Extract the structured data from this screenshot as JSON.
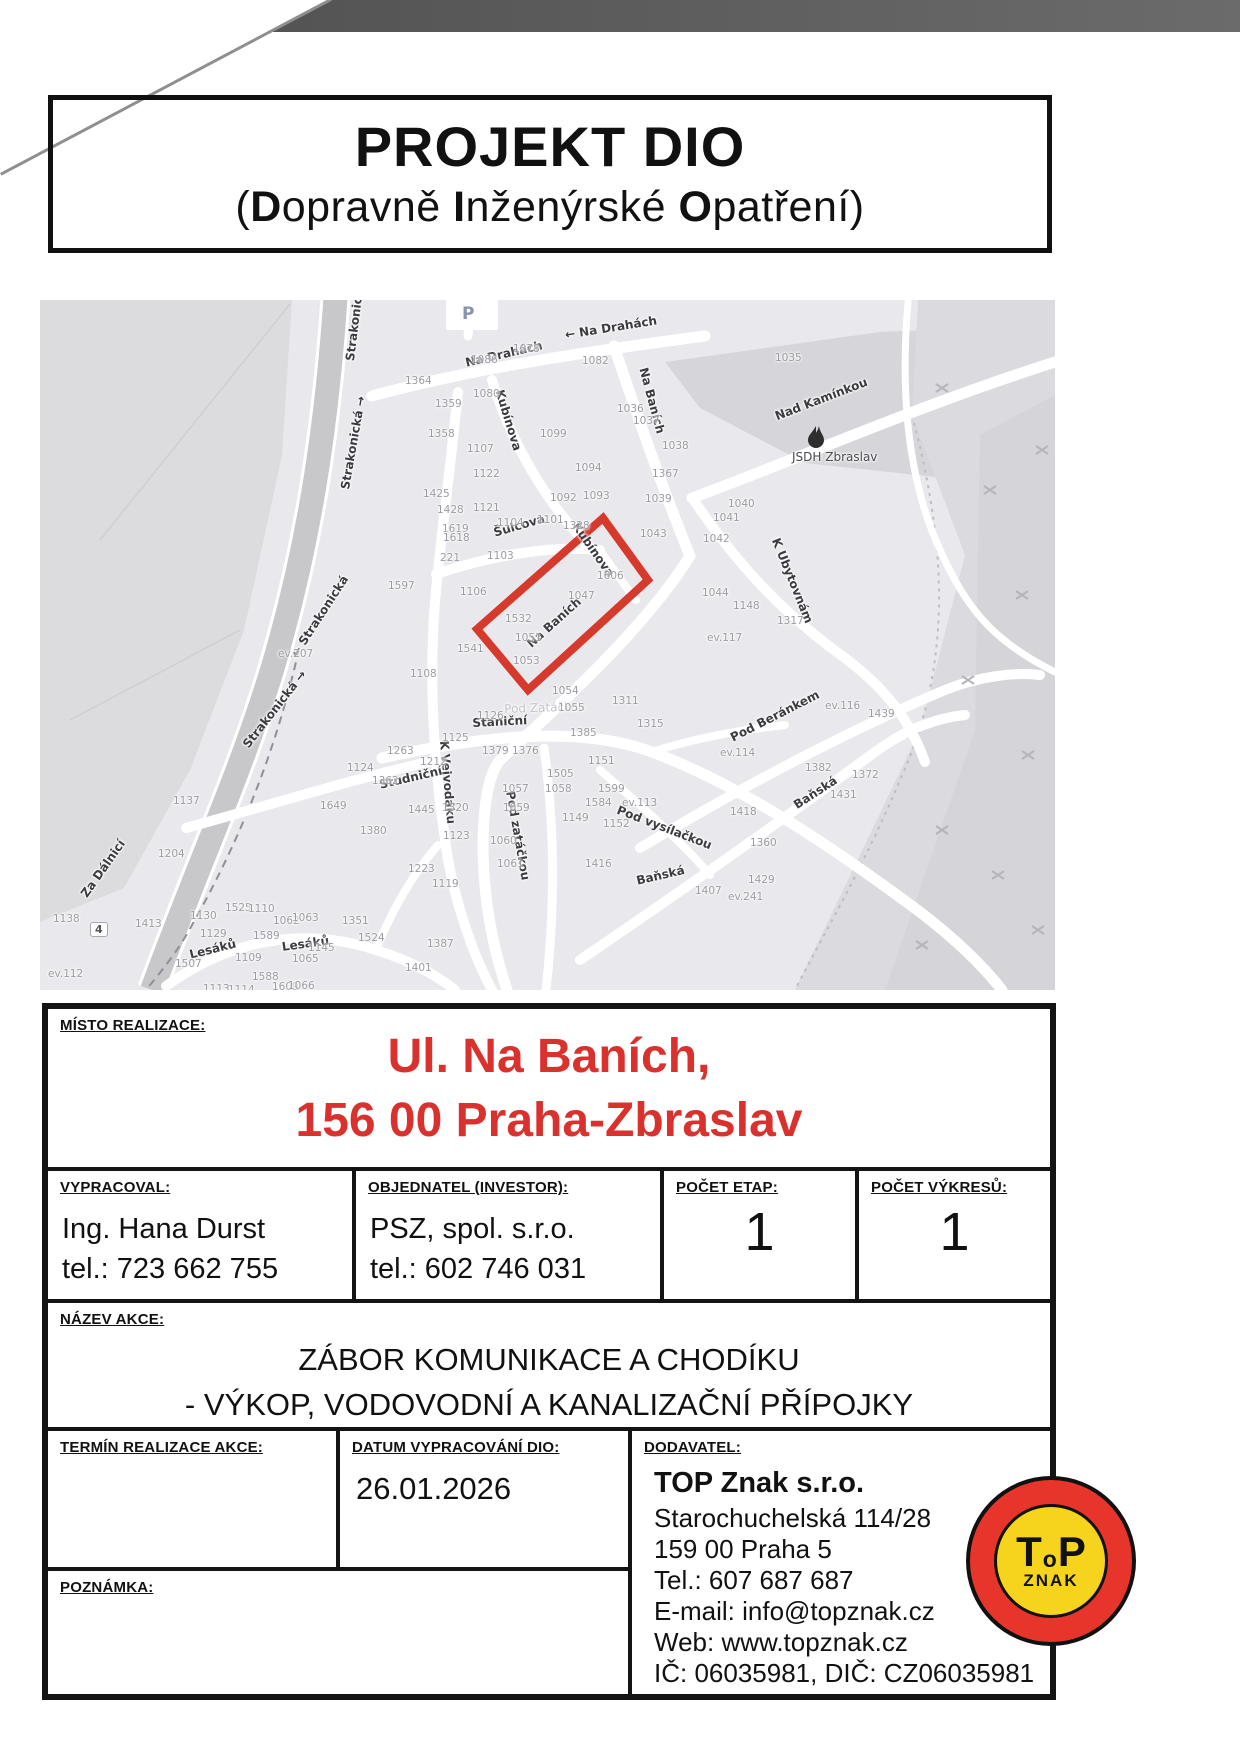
{
  "colors": {
    "text_red": "#d9322e",
    "highlight_red": "#d63a2c",
    "logo_red": "#e7352b",
    "logo_yellow": "#f6d31c"
  },
  "header": {
    "title": "PROJEKT DIO",
    "subtitle_parts": [
      {
        "t": "(",
        "b": false
      },
      {
        "t": "D",
        "b": true
      },
      {
        "t": "opravně ",
        "b": false
      },
      {
        "t": "I",
        "b": true
      },
      {
        "t": "nženýrské ",
        "b": false
      },
      {
        "t": "O",
        "b": true
      },
      {
        "t": "patření)",
        "b": false
      }
    ]
  },
  "map": {
    "street_labels": [
      {
        "t": "Strakonická",
        "x": 303,
        "y": 60,
        "r": -83
      },
      {
        "t": "Strakonická →",
        "x": 298,
        "y": 188,
        "r": -80
      },
      {
        "t": "← Strakonická",
        "x": 248,
        "y": 352,
        "r": -57
      },
      {
        "t": "Strakonická →",
        "x": 200,
        "y": 442,
        "r": -52
      },
      {
        "t": "Za Dálnicí",
        "x": 38,
        "y": 592,
        "r": -55
      },
      {
        "t": "Na Drahách",
        "x": 424,
        "y": 56,
        "r": -13
      },
      {
        "t": "← Na Drahách",
        "x": 524,
        "y": 28,
        "r": -9
      },
      {
        "t": "Na Baních",
        "x": 610,
        "y": 66,
        "r": 75
      },
      {
        "t": "Kubínova",
        "x": 466,
        "y": 88,
        "r": 73
      },
      {
        "t": "Kubínova",
        "x": 541,
        "y": 220,
        "r": 55
      },
      {
        "t": "Šulcova",
        "x": 452,
        "y": 226,
        "r": -16
      },
      {
        "t": "Nad Kamínkou",
        "x": 733,
        "y": 110,
        "r": -21
      },
      {
        "t": "K Ubytovnám",
        "x": 742,
        "y": 236,
        "r": 68
      },
      {
        "t": "Na Baních",
        "x": 484,
        "y": 340,
        "r": -42
      },
      {
        "t": "Staniční",
        "x": 432,
        "y": 416,
        "r": -3
      },
      {
        "t": "Pod Zatáčkou",
        "x": 464,
        "y": 402,
        "r": -2,
        "cls": "faint"
      },
      {
        "t": "K Vejvodáku",
        "x": 411,
        "y": 440,
        "r": 85
      },
      {
        "t": "Studniční",
        "x": 338,
        "y": 478,
        "r": -13
      },
      {
        "t": "Pod vysílačkou",
        "x": 580,
        "y": 503,
        "r": 21
      },
      {
        "t": "Pod Beránkem",
        "x": 688,
        "y": 432,
        "r": -27
      },
      {
        "t": "Baňská",
        "x": 751,
        "y": 500,
        "r": -33
      },
      {
        "t": "Baňská",
        "x": 595,
        "y": 574,
        "r": -13
      },
      {
        "t": "Pod zatáčkou",
        "x": 477,
        "y": 490,
        "r": 80
      },
      {
        "t": "Lesáků",
        "x": 148,
        "y": 648,
        "r": -14
      },
      {
        "t": "Lesáků",
        "x": 241,
        "y": 640,
        "r": -8
      },
      {
        "t": "JSDH Zbraslav",
        "x": 752,
        "y": 150,
        "r": 0,
        "cls": "poi"
      },
      {
        "t": "P",
        "x": 422,
        "y": 4,
        "r": 0,
        "cls": "parking"
      },
      {
        "t": "4",
        "x": 50,
        "y": 622,
        "r": 0,
        "cls": "shield"
      }
    ],
    "house_numbers": [
      [
        "1364",
        365,
        75
      ],
      [
        "1086",
        431,
        54
      ],
      [
        "1078",
        473,
        43
      ],
      [
        "1080",
        433,
        88
      ],
      [
        "1359",
        395,
        98
      ],
      [
        "1358",
        388,
        128
      ],
      [
        "1107",
        427,
        143
      ],
      [
        "1099",
        500,
        128
      ],
      [
        "1122",
        433,
        168
      ],
      [
        "1425",
        383,
        188
      ],
      [
        "1428",
        397,
        204
      ],
      [
        "1121",
        433,
        202
      ],
      [
        "1104",
        457,
        217
      ],
      [
        "1101",
        497,
        214
      ],
      [
        "1619",
        402,
        223
      ],
      [
        "1618",
        403,
        232
      ],
      [
        "221",
        400,
        252
      ],
      [
        "1103",
        447,
        250
      ],
      [
        "1597",
        348,
        280
      ],
      [
        "1094",
        535,
        162
      ],
      [
        "1092",
        510,
        192
      ],
      [
        "1093",
        543,
        190
      ],
      [
        "1328",
        523,
        220
      ],
      [
        "1038",
        622,
        140
      ],
      [
        "1367",
        612,
        168
      ],
      [
        "1039",
        605,
        193
      ],
      [
        "1043",
        600,
        228
      ],
      [
        "1040",
        688,
        198
      ],
      [
        "1041",
        673,
        212
      ],
      [
        "1042",
        663,
        233
      ],
      [
        "1606",
        557,
        270
      ],
      [
        "1047",
        528,
        290
      ],
      [
        "1044",
        662,
        287
      ],
      [
        "1148",
        693,
        300
      ],
      [
        "ev.117",
        667,
        332
      ],
      [
        "1051",
        475,
        332
      ],
      [
        "1053",
        473,
        355
      ],
      [
        "1106",
        420,
        286
      ],
      [
        "1541",
        417,
        343
      ],
      [
        "1108",
        370,
        368
      ],
      [
        "1054",
        512,
        385
      ],
      [
        "1532",
        465,
        313
      ],
      [
        "1055",
        518,
        402
      ],
      [
        "1126",
        437,
        410
      ],
      [
        "1125",
        402,
        432
      ],
      [
        "1263",
        347,
        445
      ],
      [
        "1212",
        380,
        456
      ],
      [
        "1124",
        307,
        462
      ],
      [
        "1362",
        332,
        475
      ],
      [
        "1649",
        280,
        500
      ],
      [
        "1445",
        368,
        504
      ],
      [
        "1320",
        402,
        502
      ],
      [
        "1380",
        320,
        525
      ],
      [
        "1123",
        403,
        530
      ],
      [
        "1223",
        368,
        563
      ],
      [
        "1119",
        392,
        578
      ],
      [
        "1379",
        442,
        445
      ],
      [
        "1376",
        472,
        445
      ],
      [
        "1057",
        462,
        483
      ],
      [
        "1059",
        463,
        502
      ],
      [
        "1060",
        450,
        535
      ],
      [
        "1061",
        457,
        558
      ],
      [
        "1385",
        530,
        427
      ],
      [
        "1505",
        507,
        468
      ],
      [
        "1058",
        505,
        483
      ],
      [
        "1151",
        548,
        455
      ],
      [
        "1599",
        558,
        483
      ],
      [
        "1584",
        545,
        497
      ],
      [
        "ev.113",
        582,
        497
      ],
      [
        "1149",
        522,
        512
      ],
      [
        "1152",
        563,
        518
      ],
      [
        "1311",
        572,
        395
      ],
      [
        "1315",
        597,
        418
      ],
      [
        "1416",
        545,
        558
      ],
      [
        "1317",
        737,
        315
      ],
      [
        "ev.116",
        785,
        400
      ],
      [
        "1439",
        828,
        408
      ],
      [
        "ev.114",
        680,
        447
      ],
      [
        "1382",
        765,
        462
      ],
      [
        "1372",
        812,
        469
      ],
      [
        "1431",
        790,
        489
      ],
      [
        "1418",
        690,
        506
      ],
      [
        "1360",
        710,
        537
      ],
      [
        "1429",
        708,
        574
      ],
      [
        "1407",
        655,
        585
      ],
      [
        "ev.241",
        688,
        591
      ],
      [
        "1035",
        735,
        52
      ],
      [
        "1082",
        542,
        55
      ],
      [
        "1036",
        577,
        103
      ],
      [
        "1037",
        593,
        115
      ],
      [
        "ev.207",
        238,
        348
      ],
      [
        "1137",
        133,
        495
      ],
      [
        "1204",
        118,
        548
      ],
      [
        "1138",
        13,
        613
      ],
      [
        "1413",
        95,
        618
      ],
      [
        "1130",
        150,
        610
      ],
      [
        "1129",
        160,
        628
      ],
      [
        "1589",
        213,
        630
      ],
      [
        "1525",
        185,
        602
      ],
      [
        "1110",
        208,
        603
      ],
      [
        "1062",
        233,
        615
      ],
      [
        "1063",
        252,
        612
      ],
      [
        "1109",
        195,
        652
      ],
      [
        "1588",
        212,
        671
      ],
      [
        "1609",
        232,
        681
      ],
      [
        "1066",
        248,
        680
      ],
      [
        "1065",
        252,
        653
      ],
      [
        "1145",
        268,
        642
      ],
      [
        "1351",
        302,
        615
      ],
      [
        "1524",
        318,
        632
      ],
      [
        "1387",
        387,
        638
      ],
      [
        "1401",
        365,
        662
      ],
      [
        "1507",
        135,
        658
      ],
      [
        "1114",
        188,
        684
      ],
      [
        "1113",
        163,
        683
      ],
      [
        "ev.112",
        8,
        668
      ]
    ]
  },
  "table": {
    "misto": {
      "label": "MÍSTO REALIZACE:",
      "line1": "Ul. Na Baních,",
      "line2": "156 00 Praha-Zbraslav"
    },
    "vypracoval": {
      "label": "VYPRACOVAL:",
      "name": "Ing. Hana Durst",
      "tel": "tel.: 723 662 755"
    },
    "objednatel": {
      "label": "OBJEDNATEL (INVESTOR):",
      "name": "PSZ, spol. s.r.o.",
      "tel": "tel.: 602 746 031"
    },
    "pocet_etap": {
      "label": "POČET ETAP:",
      "value": "1"
    },
    "pocet_vykresu": {
      "label": "POČET VÝKRESŮ:",
      "value": "1"
    },
    "nazev_akce": {
      "label": "NÁZEV AKCE:",
      "line1": "ZÁBOR KOMUNIKACE A CHODÍKU",
      "line2": "- VÝKOP, VODOVODNÍ A KANALIZAČNÍ PŘÍPOJKY"
    },
    "termin": {
      "label": "TERMÍN REALIZACE AKCE:",
      "value": ""
    },
    "datum": {
      "label": "DATUM VYPRACOVÁNÍ DIO:",
      "value": "26.01.2026"
    },
    "poznamka": {
      "label": "POZNÁMKA:",
      "value": ""
    },
    "dodavatel": {
      "label": "DODAVATEL:",
      "company": "TOP Znak s.r.o.",
      "lines": [
        "Starochuchelská 114/28",
        "159 00 Praha 5",
        "Tel.: 607 687 687",
        "E-mail: info@topznak.cz",
        "Web: www.topznak.cz",
        "IČ: 06035981, DIČ: CZ06035981"
      ]
    }
  },
  "logo": {
    "t": "T",
    "o": "o",
    "p": "P",
    "znak": "ZNAK"
  }
}
